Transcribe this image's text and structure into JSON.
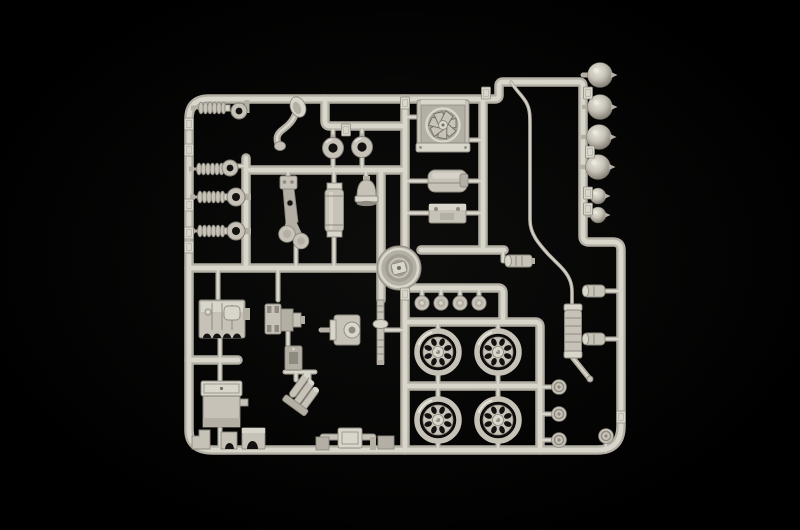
{
  "scene": {
    "type": "photograph",
    "subject": "injection-molded plastic model kit sprue (parts tree) for a vintage truck model, shot from above on a black background",
    "style": "studio photo, light grey polystyrene parts, strong dark vignette"
  },
  "colors": {
    "background": "#000000",
    "background_center": "#0d0d0c",
    "plastic": "#c6c2b7",
    "plastic_light": "#d8d5cb",
    "plastic_bright": "#e9e6dd",
    "plastic_mid": "#b3afa4",
    "plastic_dark": "#8e8a80",
    "plastic_deep": "#716e66",
    "hole": "#131210"
  },
  "parts_inventory": [
    {
      "name": "coil-spring shock absorbers",
      "count": 4
    },
    {
      "name": "suspension mounting rings",
      "count": 2
    },
    {
      "name": "suspension eyes / knuckles",
      "count": 2
    },
    {
      "name": "curved gear lever",
      "count": 1
    },
    {
      "name": "seal rings",
      "count": 2
    },
    {
      "name": "brake pedal / wishbone arm",
      "count": 1
    },
    {
      "name": "oil filter canister",
      "count": 1
    },
    {
      "name": "horn bell",
      "count": 1
    },
    {
      "name": "radiator with cooling fan",
      "count": 1
    },
    {
      "name": "fuel tank",
      "count": 1
    },
    {
      "name": "battery box",
      "count": 1
    },
    {
      "name": "round drum housing",
      "count": 1
    },
    {
      "name": "thin brake line tube",
      "count": 1
    },
    {
      "name": "muffler with tailpipe",
      "count": 1
    },
    {
      "name": "small canisters",
      "count": 3
    },
    {
      "name": "headlights large",
      "count": 4
    },
    {
      "name": "headlights small",
      "count": 2
    },
    {
      "name": "road wheels",
      "count": 4
    },
    {
      "name": "wheel hubs",
      "count": 4
    },
    {
      "name": "hub caps / discs",
      "count": 4
    },
    {
      "name": "engine block",
      "count": 1
    },
    {
      "name": "gearbox",
      "count": 1
    },
    {
      "name": "rear axle differential with driveshaft",
      "count": 1
    },
    {
      "name": "exhaust manifold (3 branch)",
      "count": 1
    },
    {
      "name": "oil pan with lid",
      "count": 1
    },
    {
      "name": "chassis brackets on bottom rail",
      "count": 5
    },
    {
      "name": "molded part-number tabs",
      "count": 14
    }
  ],
  "geometry": {
    "headlights_large": [
      [
        600,
        75
      ],
      [
        600,
        107
      ],
      [
        599,
        137
      ],
      [
        598,
        167
      ]
    ],
    "headlights_small": [
      [
        598,
        196
      ],
      [
        598,
        215
      ]
    ],
    "wheels": [
      [
        438,
        352
      ],
      [
        498,
        352
      ],
      [
        438,
        420
      ],
      [
        498,
        420
      ]
    ],
    "hubs": [
      [
        422,
        303
      ],
      [
        441,
        303
      ],
      [
        460,
        303
      ],
      [
        479,
        303
      ]
    ],
    "discs": [
      [
        559,
        387
      ],
      [
        559,
        414
      ],
      [
        559,
        440
      ],
      [
        606,
        436
      ]
    ],
    "springs": [
      [
        194,
        108
      ],
      [
        192,
        169
      ],
      [
        193,
        197
      ],
      [
        193,
        231
      ]
    ],
    "rings_small": [
      [
        239,
        111
      ],
      [
        230,
        168
      ]
    ],
    "eyes": [
      [
        236,
        197
      ],
      [
        236,
        231
      ]
    ],
    "seal_rings": [
      [
        333,
        148
      ],
      [
        362,
        147
      ]
    ],
    "tabs": [
      [
        189,
        124
      ],
      [
        189,
        150
      ],
      [
        189,
        205
      ],
      [
        189,
        233
      ],
      [
        189,
        247
      ],
      [
        405,
        103
      ],
      [
        405,
        294
      ],
      [
        346,
        130
      ],
      [
        486,
        93
      ],
      [
        588,
        93
      ],
      [
        590,
        152
      ],
      [
        588,
        193
      ],
      [
        588,
        209
      ],
      [
        621,
        417
      ]
    ]
  }
}
